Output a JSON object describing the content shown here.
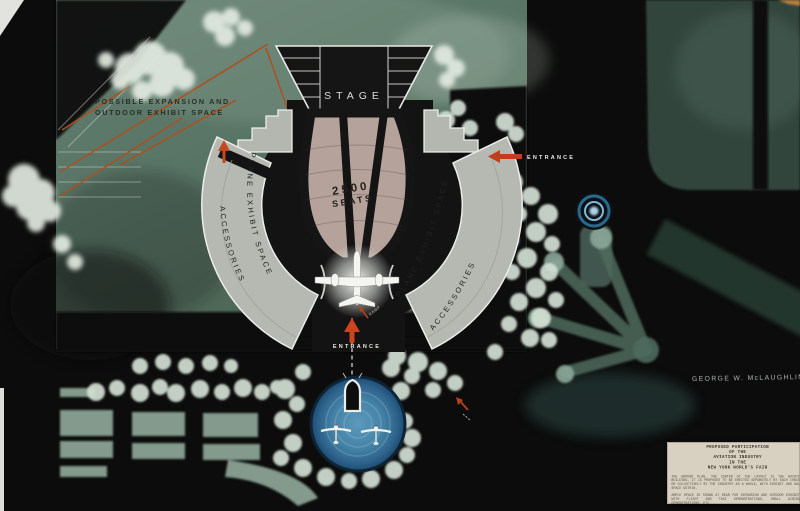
{
  "plan": {
    "expansion_label": {
      "line1": "POSSIBLE EXPANSION AND",
      "line2": "OUTDOOR EXHIBIT SPACE"
    },
    "stage_label": "STAGE",
    "seating": {
      "capacity": "2500",
      "seats_word": "SEATS"
    },
    "left_wing": {
      "inner_label": "PLANE EXHIBIT SPACE",
      "outer_label": "ACCESSORIES"
    },
    "right_wing": {
      "inner_label": "PLANE EXHIBIT SPACE",
      "outer_label": "ACCESSORIES"
    },
    "entrances": {
      "side": "ENTRANCE",
      "main": "ENTRANCE"
    },
    "ramp_label": "RAMP",
    "artist_signature": "GEORGE W. McLAUGHLIN"
  },
  "caption_card": {
    "title_lines": [
      "PROPOSED PARTICIPATION",
      "OF THE",
      "AVIATION INDUSTRY",
      "IN THE",
      "NEW YORK WORLD'S FAIR"
    ],
    "body_paragraphs": [
      "THE GROUND PLAN. THE CENTER OF THE LAYOUT IS THE AVIATION BUILDING. IT IS PROPOSED TO BE ERECTED SEPARATELY BY EACH CONCERN OR COLLECTIVELY BY THE INDUSTRY AS A WHOLE, WITH EXHIBIT AND SALES SPACE WITHIN.",
      "AMPLE SPACE IS SHOWN AT REAR FOR EXPANSION AND OUTDOOR EXHIBITS, WITH FLIGHT AND TAXI DEMONSTRATIONS, SMALL AIRCRAFT DEMONSTRATIONS, ETC."
    ]
  },
  "colors": {
    "board": "#0b0c0b",
    "park_green": "#5d7a6c",
    "wing_gray": "#b6b9b2",
    "seating_mauve": "#b5a39b",
    "arrow_red": "#c23d1c",
    "pond_blue": "#3c7ba5",
    "card_cream": "#d8d1c2"
  }
}
